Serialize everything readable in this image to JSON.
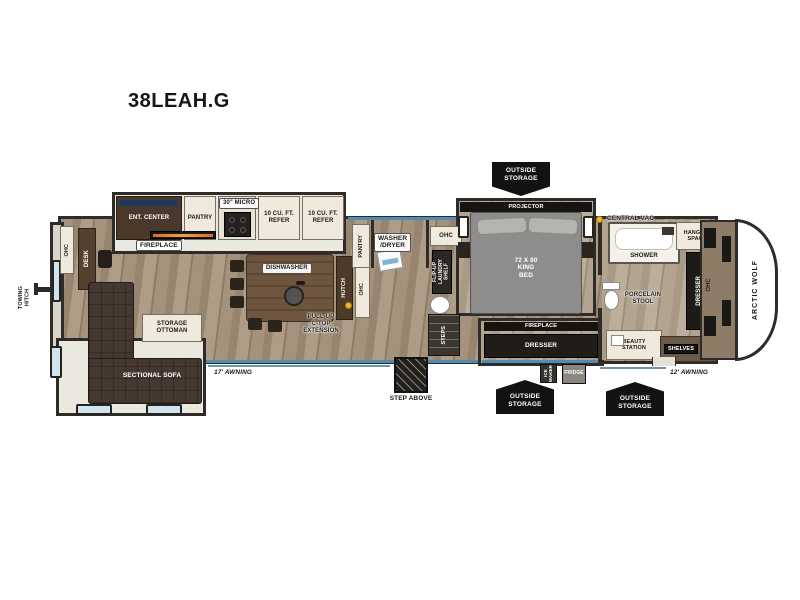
{
  "title": "38LEAH.G",
  "brand": "ARCTIC WOLF",
  "colors": {
    "wall": "#2e2b28",
    "floor_wood": "#a4927c",
    "accent_blue": "#4f8cb5",
    "window_blue": "#cfe4ef",
    "badge_black": "#141210",
    "central_vac_yellow": "#f2b62c",
    "fireplace_orange": "#f29a3a"
  },
  "labels": {
    "ent_center": "ENT. CENTER",
    "fireplace_living": "FIREPLACE",
    "pantry_kitchen": "PANTRY",
    "micro": "30\" MICRO",
    "refer_1": "10 CU. FT.\nREFER",
    "refer_2": "10 CU. FT.\nREFER",
    "ohc_rear": "OHC",
    "desk": "DESK",
    "towing_hitch": "TOWING\nHITCH",
    "storage_ottoman": "STORAGE\nOTTOMAN",
    "sectional_sofa": "SECTIONAL SOFA",
    "awning_rear": "17' AWNING",
    "dishwasher": "DISHWASHER",
    "ctop_extension": "PULL-UP\nC-TOP\nEXTENSION",
    "hutch": "HUTCH",
    "ohc_island": "OHC",
    "pantry_laundry": "PANTRY",
    "washer_dryer": "WASHER\n/DRYER",
    "ohc_laundry": "OHC",
    "flip_up_shelf": "FLIP-UP\nLAUNDRY SHELF",
    "steps": "STEPS",
    "step_above": "STEP ABOVE",
    "outside_storage_top": "OUTSIDE\nSTORAGE",
    "outside_storage_left": "OUTSIDE\nSTORAGE",
    "outside_storage_right": "OUTSIDE\nSTORAGE",
    "projector": "PROJECTOR",
    "king_bed": "72 X 80\nKING\nBED",
    "central_vac": "CENTRAL VAC",
    "fireplace_bedroom": "FIREPLACE",
    "dresser_bedroom": "DRESSER",
    "ice_maker": "ICE\nMAKER",
    "fridge": "FRIDGE",
    "shower": "SHOWER",
    "porcelain_stool": "PORCELAIN\nSTOOL",
    "hanging_space": "HANGING\nSPACE",
    "dresser_front": "DRESSER",
    "beauty_station": "BEAUTY\nSTATION",
    "shelves": "SHELVES",
    "ohc_front": "OHC",
    "awning_front": "12' AWNING"
  }
}
